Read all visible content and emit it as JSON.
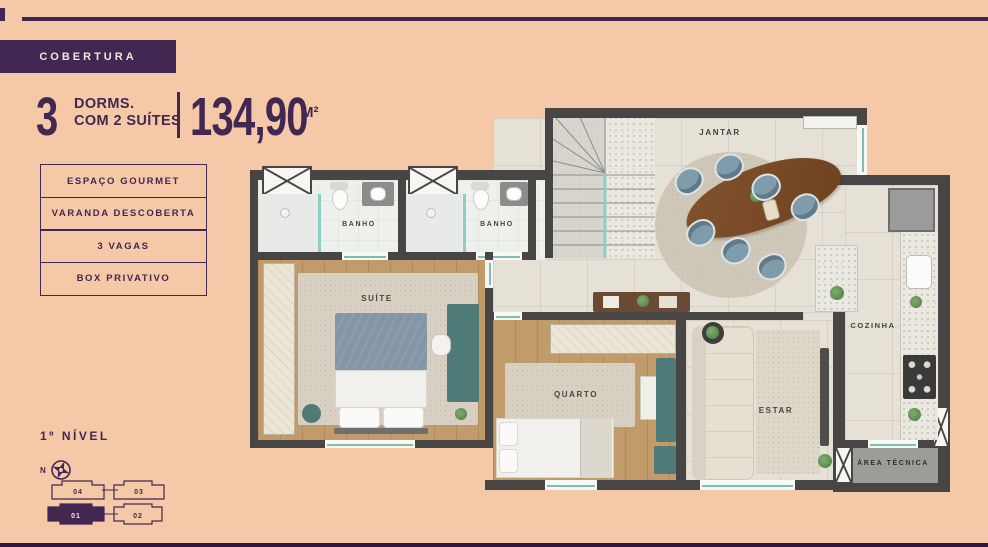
{
  "header": {
    "badge": "COBERTURA",
    "dorms_number": "3",
    "dorms_line1": "DORMS.",
    "dorms_line2": "COM 2 SUÍTES",
    "area_value": "134,90",
    "area_unit": "M²"
  },
  "features": [
    {
      "label": "ESPAÇO GOURMET"
    },
    {
      "label": "VARANDA DESCOBERTA"
    },
    {
      "label": "3 VAGAS"
    },
    {
      "label": "BOX PRIVATIVO"
    }
  ],
  "level": {
    "label": "1º NÍVEL"
  },
  "compass": {
    "label": "N"
  },
  "keyplan": {
    "units": [
      {
        "id": "04",
        "active": false
      },
      {
        "id": "03",
        "active": false
      },
      {
        "id": "01",
        "active": true
      },
      {
        "id": "02",
        "active": false
      }
    ]
  },
  "floorplan": {
    "rooms": {
      "banho1": "BANHO",
      "banho2": "BANHO",
      "suite": "SUÍTE",
      "quarto": "QUARTO",
      "estar": "ESTAR",
      "jantar": "JANTAR",
      "cozinha": "COZINHA",
      "area_tecnica": "ÁREA TÉCNICA"
    }
  },
  "colors": {
    "accent_purple": "#412752",
    "background_peach": "#f5c8a7",
    "wall_gray": "#474645",
    "glass_teal": "#8fccc3"
  }
}
